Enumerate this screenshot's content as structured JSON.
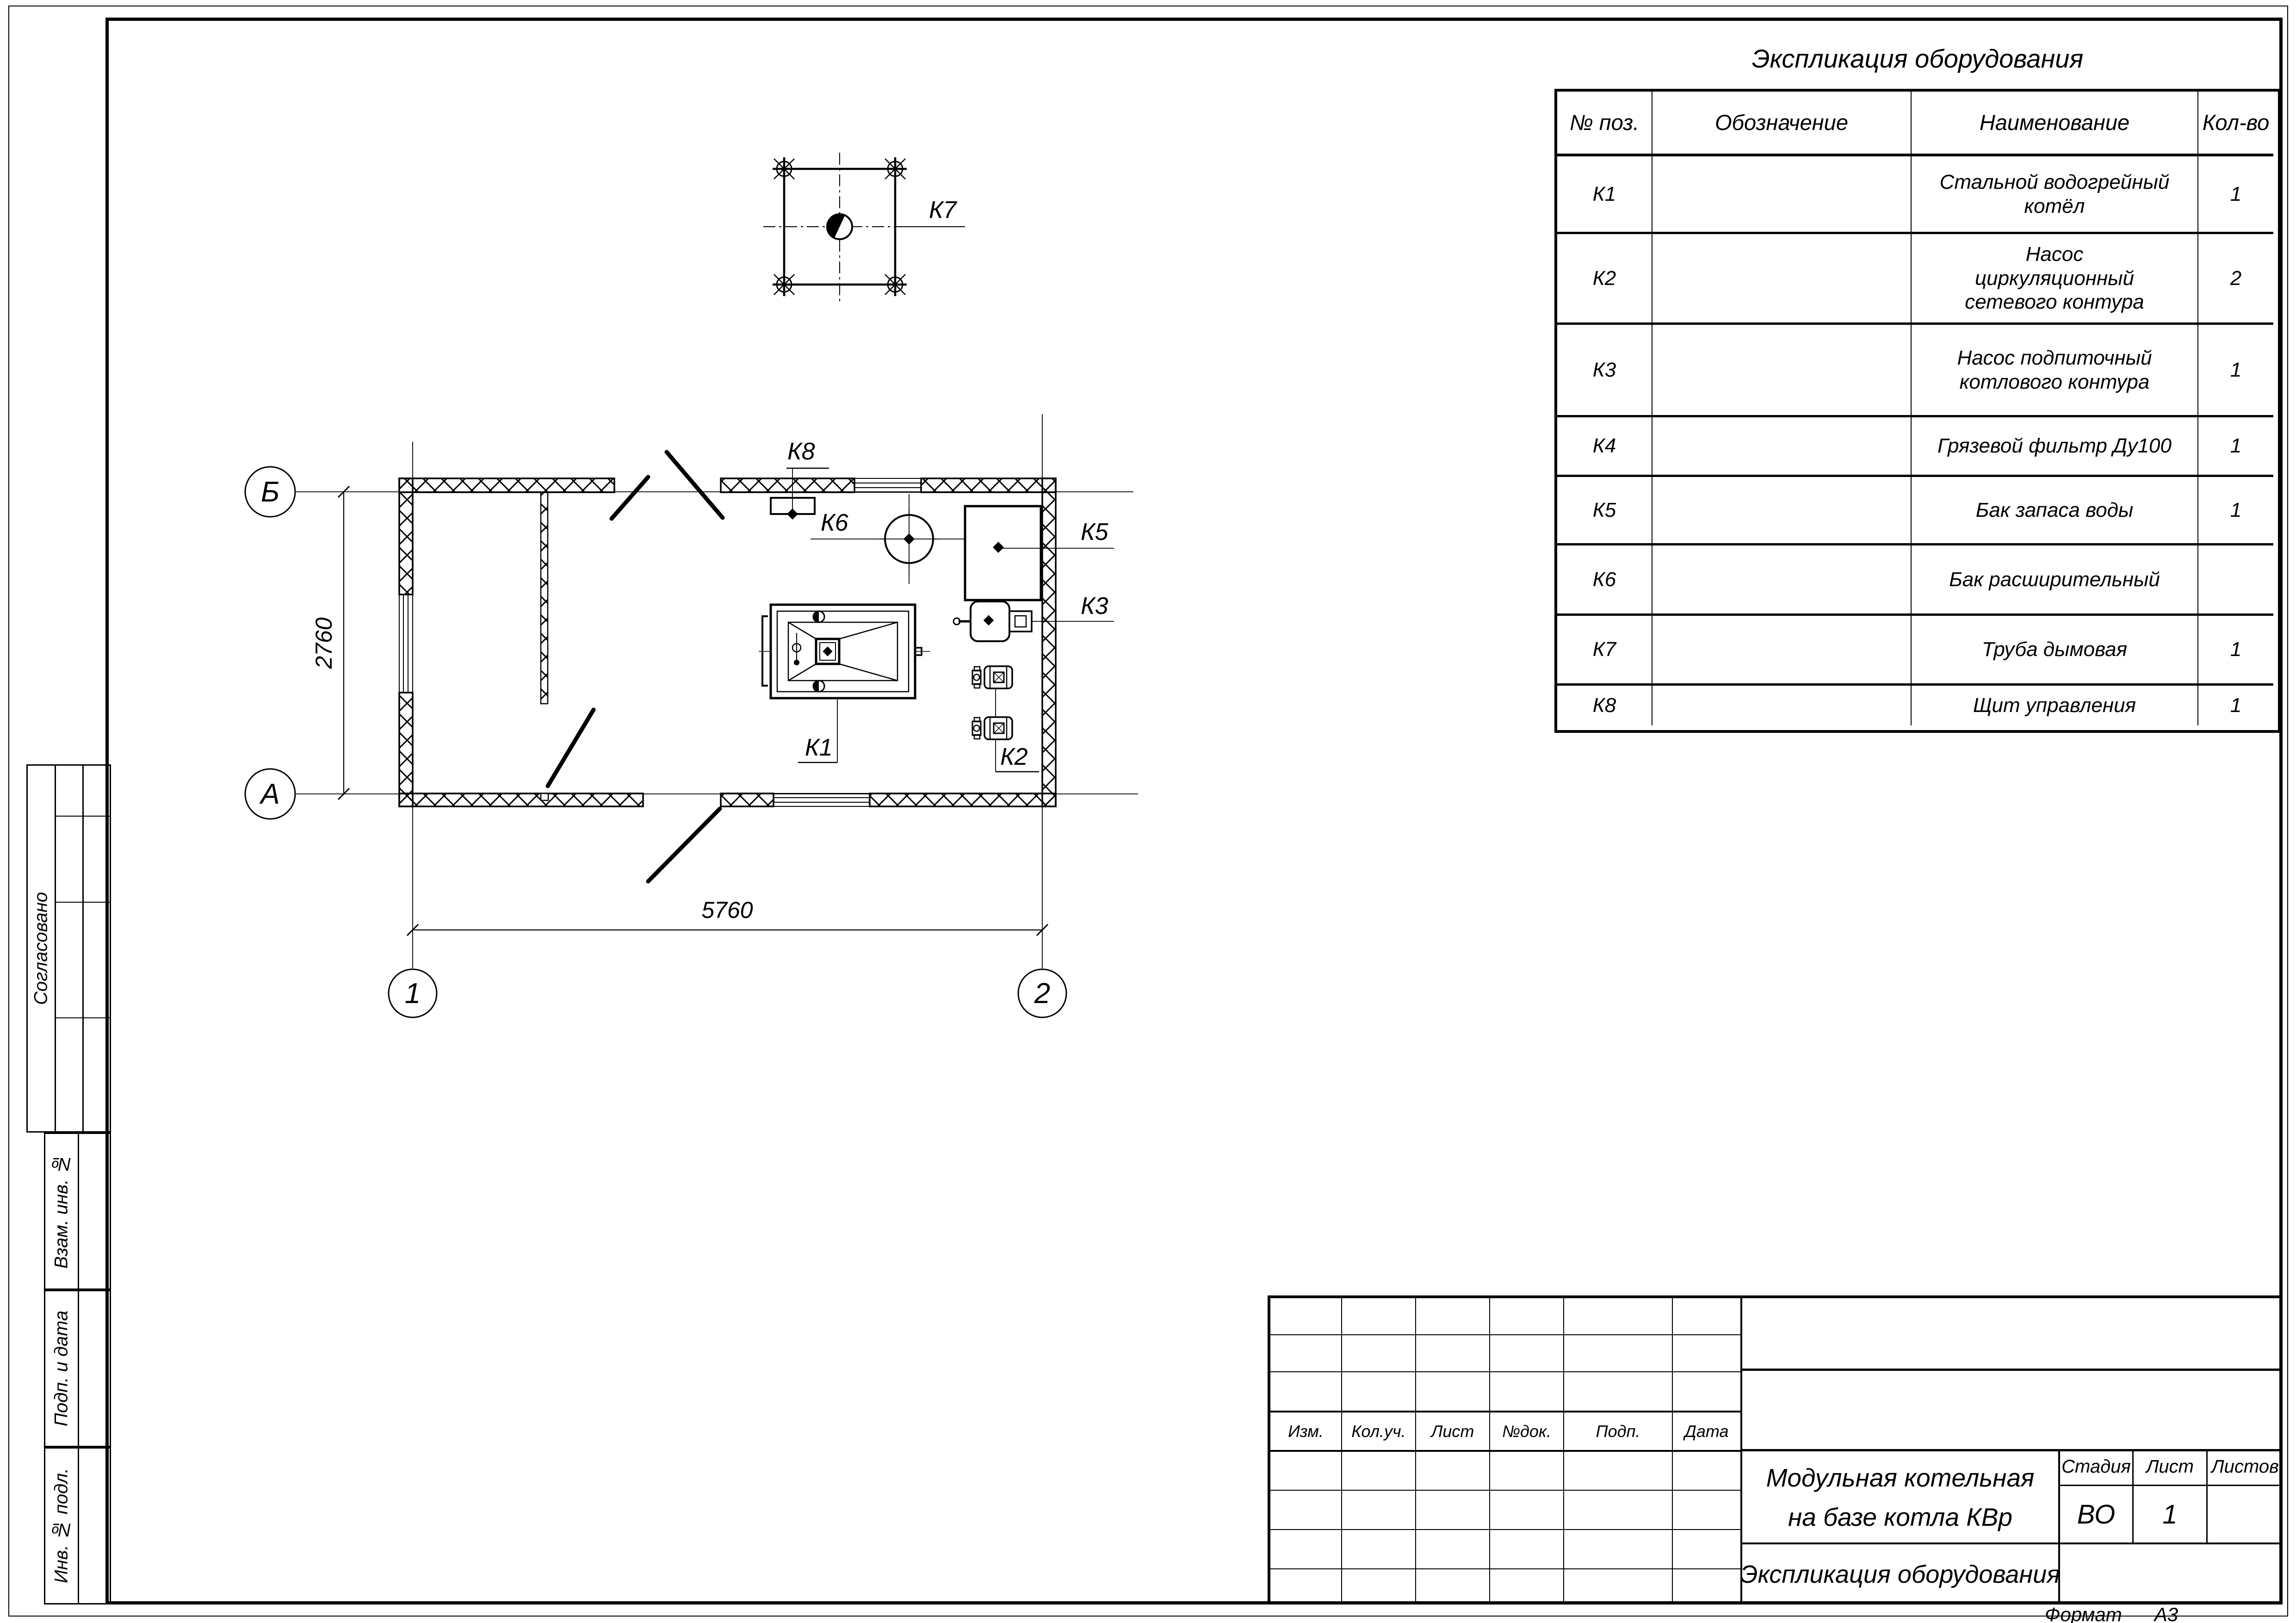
{
  "sheet": {
    "format_label": "Формат",
    "format_value": "А3"
  },
  "equipment_table": {
    "title": "Экспликация оборудования",
    "col_pos": "№ поз.",
    "col_designation": "Обозначение",
    "col_name": "Наименование",
    "col_qty": "Кол-во",
    "rows": [
      {
        "pos": "К1",
        "designation": "",
        "name": "Стальной водогрейный котёл",
        "qty": "1"
      },
      {
        "pos": "К2",
        "designation": "",
        "name": "Насос циркуляционный сетевого контура",
        "qty": "2"
      },
      {
        "pos": "К3",
        "designation": "",
        "name": "Насос подпиточный котлового контура",
        "qty": "1"
      },
      {
        "pos": "К4",
        "designation": "",
        "name": "Грязевой фильтр Ду100",
        "qty": "1"
      },
      {
        "pos": "К5",
        "designation": "",
        "name": "Бак запаса воды",
        "qty": "1"
      },
      {
        "pos": "К6",
        "designation": "",
        "name": "Бак расширительный",
        "qty": ""
      },
      {
        "pos": "К7",
        "designation": "",
        "name": "Труба дымовая",
        "qty": "1"
      },
      {
        "pos": "К8",
        "designation": "",
        "name": "Щит управления",
        "qty": "1"
      }
    ]
  },
  "plan": {
    "axis_b": "Б",
    "axis_a": "А",
    "axis_1": "1",
    "axis_2": "2",
    "dim_width": "5760",
    "dim_height": "2760",
    "labels": {
      "k1": "К1",
      "k2": "К2",
      "k3": "К3",
      "k5": "К5",
      "k6": "К6",
      "k7": "К7",
      "k8": "К8"
    }
  },
  "title_block": {
    "rev_cols": [
      "Изм.",
      "Кол.уч.",
      "Лист",
      "№док.",
      "Подп.",
      "Дата"
    ],
    "project_line1": "Модульная котельная",
    "project_line2": "на базе котла КВр",
    "doc_title": "Экспликация оборудования",
    "stage_label": "Стадия",
    "sheet_label": "Лист",
    "sheets_label": "Листов",
    "stage": "ВО",
    "sheet": "1",
    "sheets": ""
  },
  "side_stamp": {
    "approved": "Согласовано",
    "replace_inv": "Взам. инв. №",
    "sign_date": "Подп. и дата",
    "inv_orig": "Инв. № подл."
  }
}
